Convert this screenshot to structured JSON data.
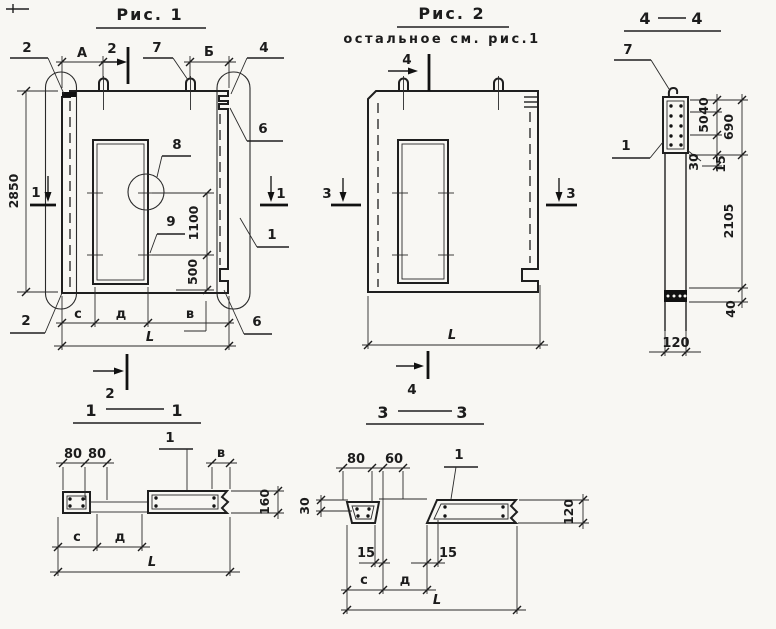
{
  "figure1": {
    "title": "Рис. 1",
    "dims": {
      "a": "А",
      "b": "Б",
      "height_2850": "2850",
      "opening_1100": "1100",
      "below_500": "500",
      "c": "с",
      "d": "д",
      "v": "в",
      "length": "L"
    },
    "callouts": {
      "corner_top_left": "2",
      "loop": "7",
      "corner_top_right": "4",
      "notch_top_right": "6",
      "panel_edge": "1",
      "notch_bottom_right": "6",
      "corner_bottom_left": "2",
      "detail_circle": "8",
      "tick": "9"
    },
    "markers": {
      "s2_top": "2",
      "s2_bottom": "2",
      "s1_left": "1",
      "s1_right": "1"
    }
  },
  "figure2": {
    "title": "Рис. 2",
    "subtitle": "остальное см. рис.1",
    "dims": {
      "length": "L"
    },
    "markers": {
      "s4_top": "4",
      "s4_bottom": "4",
      "s3_left": "3",
      "s3_right": "3"
    }
  },
  "section44": {
    "title_left": "4",
    "title_right": "4",
    "callouts": {
      "loop": "7",
      "panel": "1"
    },
    "dims": {
      "top_40": "40",
      "mid_50": "50",
      "block_690": "690",
      "bot_30": "30",
      "bot_15": "15",
      "shaft_2105": "2105",
      "pad_40": "40",
      "width_120": "120"
    }
  },
  "section11": {
    "title_left": "1",
    "title_right": "1",
    "callouts": {
      "panel": "1"
    },
    "dims": {
      "left_80": "80",
      "right_80": "80",
      "v": "в",
      "height_160": "160",
      "c": "с",
      "d": "д",
      "length": "L"
    }
  },
  "section33": {
    "title_left": "3",
    "title_right": "3",
    "callouts": {
      "panel": "1"
    },
    "dims": {
      "d80": "80",
      "d60": "60",
      "d30": "30",
      "height_120": "120",
      "lip_15_left": "15",
      "lip_15_right": "15",
      "c": "с",
      "d": "д",
      "length": "L"
    }
  }
}
